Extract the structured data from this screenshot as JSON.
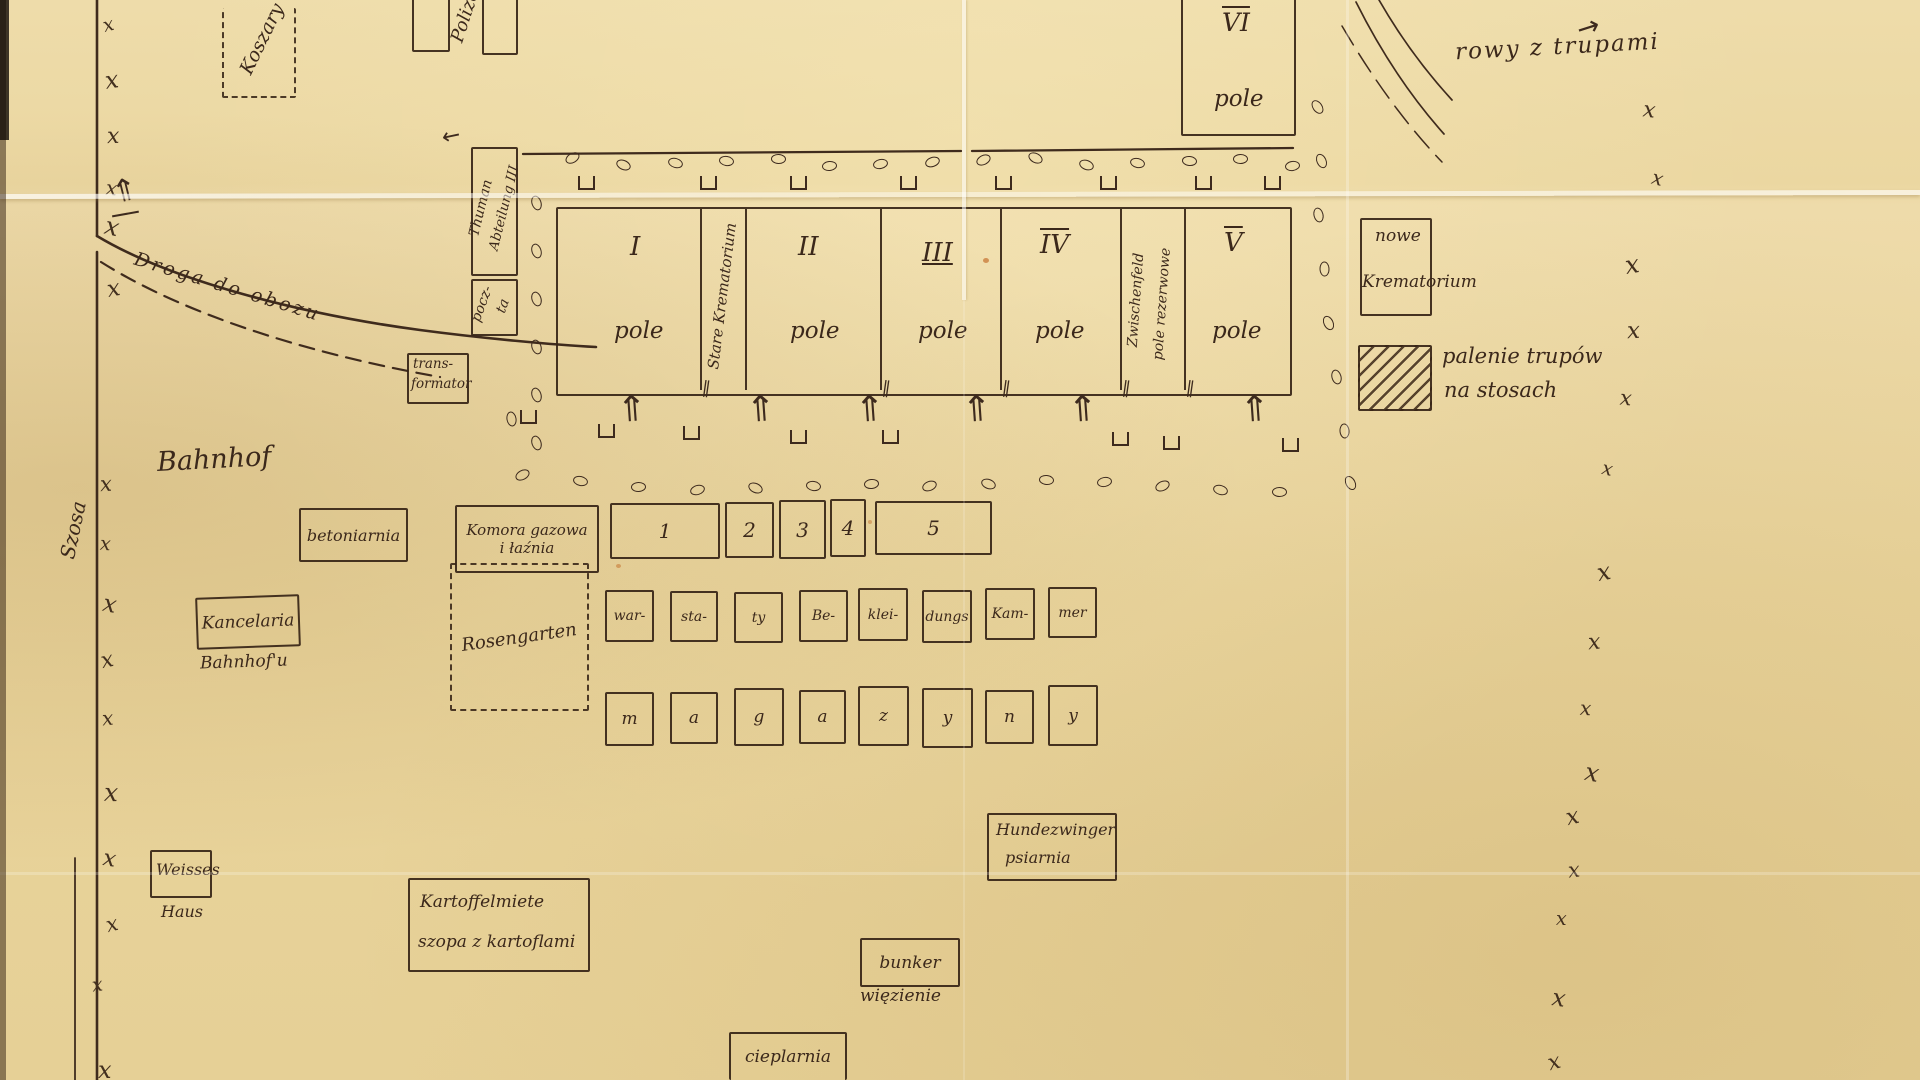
{
  "colors": {
    "paper": "#ebd7a0",
    "ink": "#3d2a1e"
  },
  "marks": {
    "boundary_glyph": "x"
  },
  "top_area": {
    "koszary": "Koszary",
    "polizei": "Polizei",
    "field_vi_numeral": "VI",
    "field_vi_label": "pole",
    "rowy_z_trupami": "rowy z trupami"
  },
  "left_structures": {
    "thuman_line1": "Thuman",
    "thuman_line2": "Abteilung III",
    "poczta_line1": "pocz-",
    "poczta_line2": "ta",
    "trafo_line1": "trans-",
    "trafo_line2": "formator"
  },
  "fields": {
    "stare_krematorium": "Stare Krematorium",
    "zwischenfeld_line1": "Zwischenfeld",
    "zwischenfeld_line2": "pole rezerwowe",
    "list": [
      {
        "numeral": "I",
        "label": "pole"
      },
      {
        "numeral": "II",
        "label": "pole"
      },
      {
        "numeral": "III",
        "label": "pole"
      },
      {
        "numeral": "IV",
        "label": "pole"
      },
      {
        "numeral": "V",
        "label": "pole"
      }
    ]
  },
  "right_area": {
    "nowe_krematorium_line1": "nowe",
    "nowe_krematorium_line2": "Krematorium",
    "pyres_line1": "palenie trupów",
    "pyres_line2": "na stosach"
  },
  "roads": {
    "bahnhof": "Bahnhof",
    "szosa": "Szosa",
    "droga_do_obozu": "Droga do obozu"
  },
  "central_buildings": {
    "betoniarnia": "betoniarnia",
    "komora_line1": "Komora gazowa",
    "komora_line2": "i łaźnia",
    "rosengarten": "Rosengarten",
    "numbered": [
      "1",
      "2",
      "3",
      "4",
      "5"
    ],
    "workshops": [
      "war-",
      "sta-",
      "ty",
      "Be-",
      "klei-",
      "dungs",
      "Kam-",
      "mer"
    ],
    "magazyny": [
      "m",
      "a",
      "g",
      "a",
      "z",
      "y",
      "n",
      "y"
    ]
  },
  "south_buildings": {
    "kancelaria": "Kancelaria",
    "kancelaria_sub": "Bahnhof'u",
    "weisses": "Weisses",
    "weisses_sub": "Haus",
    "kartoffel_line1": "Kartoffelmiete",
    "kartoffel_line2": "szopa z kartoflami",
    "hundezwinger_line1": "Hundezwinger",
    "hundezwinger_line2": "psiarnia",
    "bunker": "bunker",
    "bunker_sub": "więzienie",
    "cieplarnia": "cieplarnia"
  }
}
